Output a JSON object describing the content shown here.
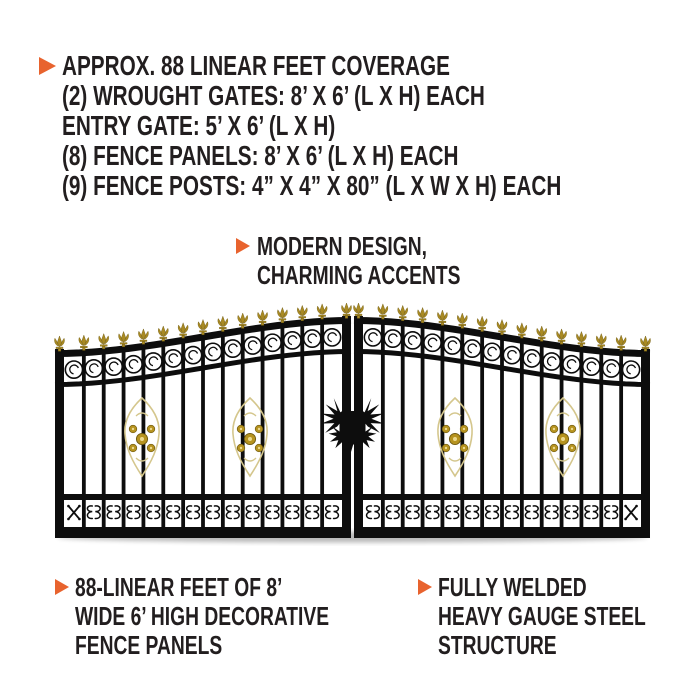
{
  "palette": {
    "text": "#221e1f",
    "bullet": "#e8632e",
    "gate_black": "#0d0d0d",
    "gold": "#a98a23",
    "gold_dark": "#6f5a12",
    "gold_light": "#d9c05a",
    "pale_gold": "#d4c68c",
    "flower_gold": "#b6931f",
    "flower_center": "#ecd98e",
    "background": "#ffffff"
  },
  "features": {
    "lines": [
      "APPROX. 88 LINEAR FEET COVERAGE",
      "(2) WROUGHT GATES: 8’ X 6’ (L X H) EACH",
      "ENTRY GATE: 5’ X 6’ (L X H)",
      "(8) FENCE PANELS: 8’ X 6’ (L X H) EACH",
      "(9) FENCE POSTS: 4” X 4” X 80” (L X W X H) EACH"
    ]
  },
  "design_note": {
    "lines": [
      "MODERN DESIGN,",
      "CHARMING ACCENTS"
    ]
  },
  "bottom_notes": [
    {
      "lines": [
        "88-LINEAR FEET OF 8’",
        "WIDE 6’ HIGH DECORATIVE",
        "FENCE PANELS"
      ]
    },
    {
      "lines": [
        "FULLY WELDED",
        "HEAVY GAUGE STEEL",
        "STRUCTURE"
      ]
    }
  ],
  "gate": {
    "alt": "black dual-swing wrought iron gate with gold fleur-de-lis finials, scroll band, gold medallions and center eagle ornament",
    "left": 55,
    "right": 650,
    "top_outer": 350,
    "top_center": 317,
    "rail2_offset": 32,
    "bottom_rail_y": 497,
    "band_bottom_y": 527,
    "frame_bottom_y": 538,
    "stile_w": 9,
    "center_gap": 3,
    "picket_w": 3.8,
    "gaps_per_leaf": 14,
    "medallions_x": [
      142,
      250,
      455,
      563
    ],
    "medallion_cy": 439,
    "eagle_cx": 352.5,
    "eagle_cy": 427
  }
}
